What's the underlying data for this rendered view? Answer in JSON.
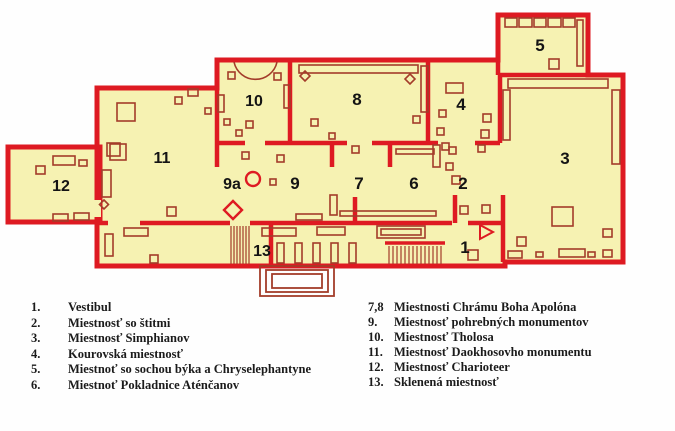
{
  "plan": {
    "rooms": [
      {
        "id": "1",
        "label": "1"
      },
      {
        "id": "2",
        "label": "2"
      },
      {
        "id": "3",
        "label": "3"
      },
      {
        "id": "4",
        "label": "4"
      },
      {
        "id": "5",
        "label": "5"
      },
      {
        "id": "6",
        "label": "6"
      },
      {
        "id": "7",
        "label": "7"
      },
      {
        "id": "8",
        "label": "8"
      },
      {
        "id": "9",
        "label": "9"
      },
      {
        "id": "9a",
        "label": "9a"
      },
      {
        "id": "10",
        "label": "10"
      },
      {
        "id": "11",
        "label": "11"
      },
      {
        "id": "12",
        "label": "12"
      },
      {
        "id": "13",
        "label": "13"
      }
    ],
    "colors": {
      "wall": "#de1a22",
      "room_fill": "#f6f2b2",
      "furniture": "#a33c2a",
      "label": "#141414",
      "background": "#fefefe"
    }
  },
  "legend": {
    "left": [
      {
        "num": "1.",
        "label": "Vestibul"
      },
      {
        "num": "2.",
        "label": "Miestnosť so štitmi"
      },
      {
        "num": "3.",
        "label": "Miestnosť Simphianov"
      },
      {
        "num": "4.",
        "label": "Kourovská miestnosť"
      },
      {
        "num": "5.",
        "label": "Miestnoť so sochou býka a Chryselephantyne"
      },
      {
        "num": "6.",
        "label": "Miestnoť Pokladnice Aténčanov"
      }
    ],
    "right": [
      {
        "num": "7,8",
        "label": "Miestnosti Chrámu Boha Apolóna"
      },
      {
        "num": "9.",
        "label": "Miestnosť pohrebných monumentov"
      },
      {
        "num": "10.",
        "label": "Miestnosť Tholosa"
      },
      {
        "num": "11.",
        "label": "Miestnosť Daokhosovho monumentu"
      },
      {
        "num": "12.",
        "label": "Miestnosť Charioteer"
      },
      {
        "num": "13.",
        "label": "Sklenená miestnosť"
      }
    ]
  }
}
